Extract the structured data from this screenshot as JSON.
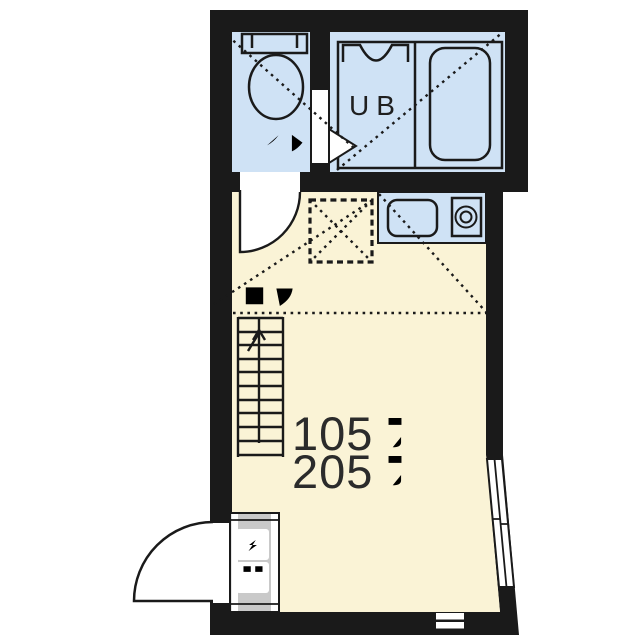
{
  "page": {
    "kind": "apartment floor plan",
    "background": "#ffffff"
  },
  "plan": {
    "rooms": {
      "toilet": {
        "label": "トイレ"
      },
      "unit_bath": {
        "label": "UB"
      },
      "main_room": {
        "loft_label": "ロフト",
        "room_numbers": [
          {
            "number": "105",
            "suffix": "号室"
          },
          {
            "number": "205",
            "suffix": "号室"
          }
        ]
      },
      "entrance": {
        "label": "玄関"
      }
    },
    "fixtures": [
      "toilet-tank",
      "toilet-bowl",
      "washstand",
      "bathtub",
      "kitchen-sink",
      "stove-burner",
      "loft-ladder-stairs",
      "room-door-arc",
      "bath-door-triangle",
      "entrance-door-arc",
      "sliding-window",
      "vent-slats",
      "loft-hatch-dashed-square"
    ],
    "colors": {
      "wall": "#1a1a1a",
      "wet_area_fill": "#cfe2f5",
      "floor_fill": "#faf3d6",
      "entrance_floor": "#c9c9c9",
      "outline": "#1a1a1a",
      "text": "#2b2b2b"
    }
  }
}
